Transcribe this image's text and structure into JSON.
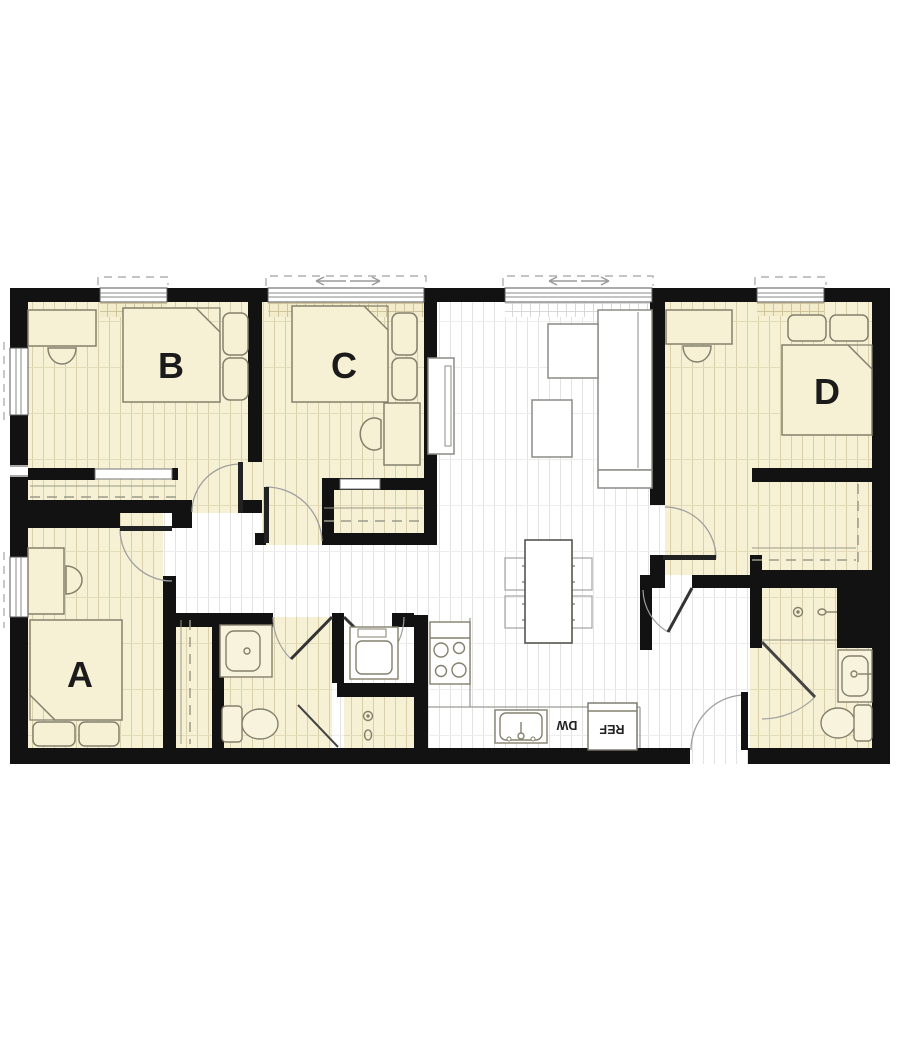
{
  "plan": {
    "type": "apartment-floor-plan",
    "rooms": {
      "a": {
        "label": "A"
      },
      "b": {
        "label": "B"
      },
      "c": {
        "label": "C"
      },
      "d": {
        "label": "D"
      }
    },
    "kitchen": {
      "dishwasher_label": "DW",
      "refrigerator_label": "REF"
    },
    "fixtures": [
      "bed",
      "pillow",
      "desk",
      "desk-chair",
      "closet-rod",
      "sofa",
      "chaise",
      "coffee-table",
      "tv-console",
      "dining-table",
      "dining-chair",
      "stove",
      "kitchen-sink",
      "dishwasher",
      "refrigerator",
      "washer-dryer",
      "toilet",
      "bathroom-sink",
      "shower-head",
      "door-swing",
      "window",
      "sliding-window-arrows"
    ],
    "colors": {
      "wall": "#121212",
      "wood_floor": "#f6f0d4",
      "wood_floor_line": "#d9cfa8",
      "white_floor": "#ffffff",
      "white_floor_line": "#e3e3e3",
      "furniture_outline": "#84806d",
      "door_arc": "#9f9f9f",
      "label_text": "#1b1b1b"
    }
  }
}
